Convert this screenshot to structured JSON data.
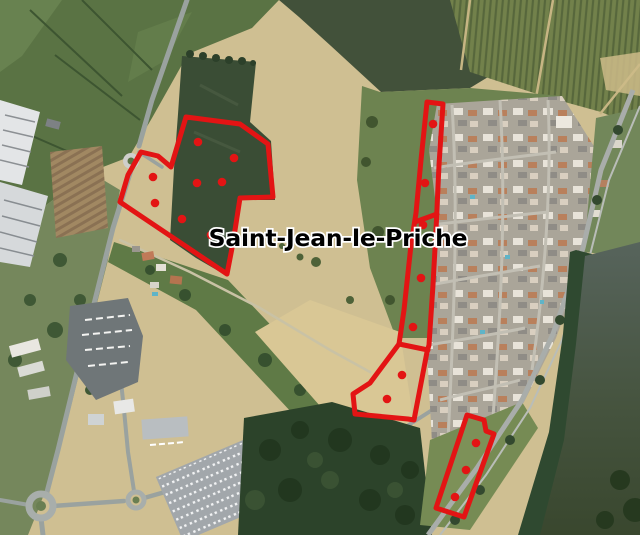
{
  "map": {
    "place_label": "Saint-Jean-le-Priche",
    "label_position": {
      "x": 338,
      "y": 246
    },
    "overlay": {
      "color": "#e31414",
      "stroke_width": 5,
      "dot_radius": 4.3
    },
    "zones": [
      {
        "name": "west-parcel",
        "points": [
          [
            186,
            117
          ],
          [
            240,
            124
          ],
          [
            268,
            144
          ],
          [
            273,
            197
          ],
          [
            240,
            198
          ],
          [
            233,
            243
          ],
          [
            227,
            274
          ],
          [
            120,
            202
          ],
          [
            128,
            175
          ],
          [
            141,
            152
          ],
          [
            158,
            156
          ],
          [
            171,
            167
          ]
        ],
        "dots": [
          [
            198,
            142
          ],
          [
            234,
            158
          ],
          [
            153,
            177
          ],
          [
            197,
            183
          ],
          [
            222,
            182
          ],
          [
            155,
            203
          ],
          [
            182,
            219
          ],
          [
            211,
            235
          ]
        ]
      },
      {
        "name": "central-strip",
        "points": [
          [
            427,
            102
          ],
          [
            443,
            104
          ],
          [
            439,
            165
          ],
          [
            436,
            230
          ],
          [
            433,
            285
          ],
          [
            429,
            345
          ],
          [
            427,
            352
          ],
          [
            414,
            420
          ],
          [
            408,
            419
          ],
          [
            355,
            414
          ],
          [
            353,
            394
          ],
          [
            370,
            383
          ],
          [
            399,
            344
          ],
          [
            404,
            310
          ],
          [
            411,
            245
          ],
          [
            416,
            213
          ],
          [
            421,
            160
          ]
        ],
        "dividers": [
          [
            [
              415,
              222
            ],
            [
              437,
              214
            ]
          ],
          [
            [
              399,
              344
            ],
            [
              428,
              350
            ]
          ]
        ],
        "dots": [
          [
            433,
            124
          ],
          [
            425,
            183
          ],
          [
            423,
            225
          ],
          [
            421,
            278
          ],
          [
            413,
            327
          ],
          [
            402,
            375
          ],
          [
            387,
            399
          ]
        ]
      },
      {
        "name": "riverside-parcel",
        "points": [
          [
            467,
            415
          ],
          [
            484,
            420
          ],
          [
            486,
            431
          ],
          [
            494,
            434
          ],
          [
            464,
            517
          ],
          [
            436,
            508
          ]
        ],
        "dots": [
          [
            476,
            443
          ],
          [
            466,
            470
          ],
          [
            455,
            497
          ]
        ]
      }
    ]
  }
}
